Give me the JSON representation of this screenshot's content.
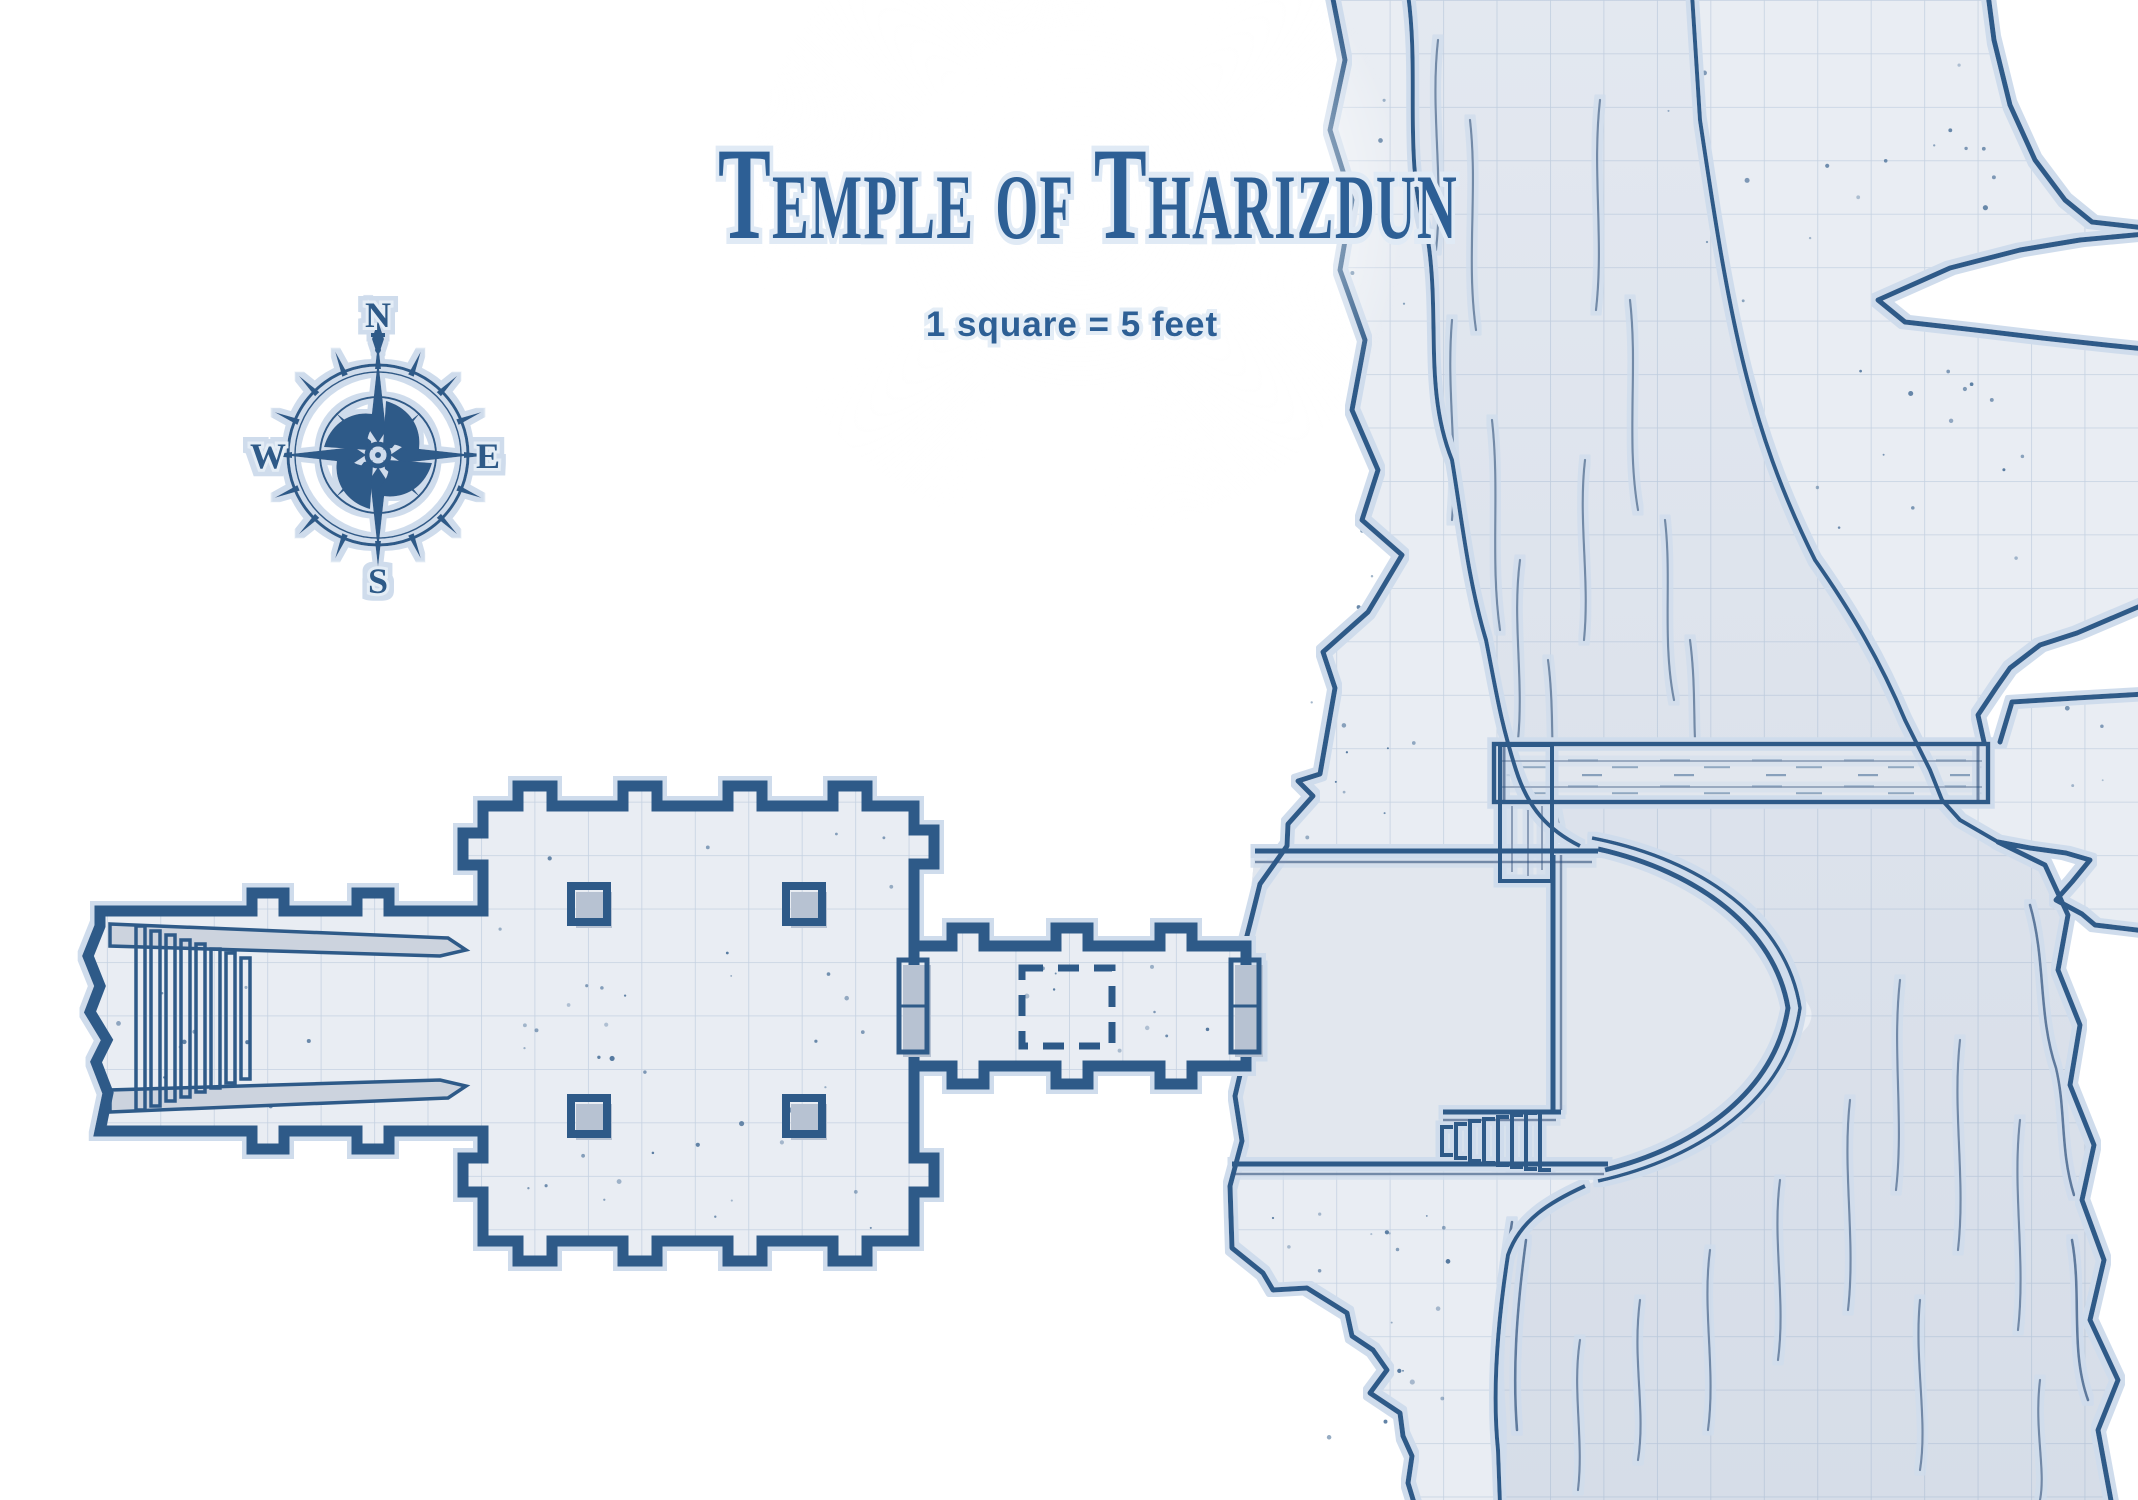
{
  "title": "Temple of Tharizdun",
  "scale_note": "1 square = 5 feet",
  "compass": {
    "north": "N",
    "south": "S",
    "east": "E",
    "west": "W"
  },
  "colors": {
    "ink": "#2e5a88",
    "title_blue": "#2d5f95",
    "paper": "#ffffff",
    "floor": "#e9edf3",
    "water": "#dce2eb",
    "grid_line": "#7f9cc0",
    "wood": "#e2e7ee",
    "halo": "#cfdcec",
    "shadow": "#b7c2d2"
  }
}
